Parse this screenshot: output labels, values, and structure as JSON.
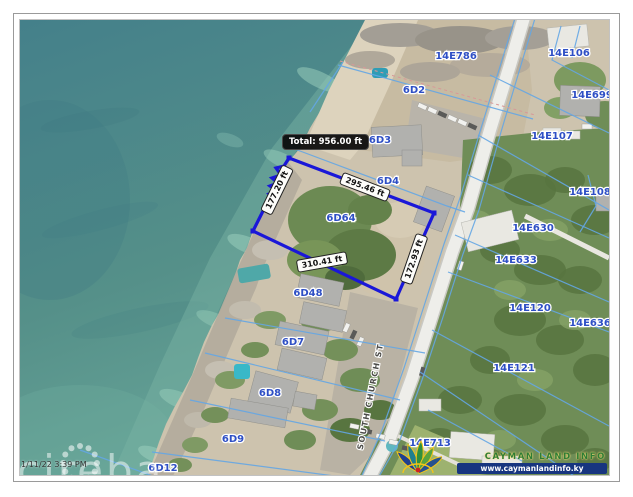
{
  "map": {
    "parcels": [
      {
        "id": "14E786"
      },
      {
        "id": "6D2"
      },
      {
        "id": "6D3"
      },
      {
        "id": "6D4"
      },
      {
        "id": "6D64"
      },
      {
        "id": "6D48"
      },
      {
        "id": "6D7"
      },
      {
        "id": "6D8"
      },
      {
        "id": "6D9"
      },
      {
        "id": "6D12"
      },
      {
        "id": "14E106"
      },
      {
        "id": "14E699"
      },
      {
        "id": "14E107"
      },
      {
        "id": "14E108"
      },
      {
        "id": "14E630"
      },
      {
        "id": "14E633"
      },
      {
        "id": "14E120"
      },
      {
        "id": "14E636"
      },
      {
        "id": "14E121"
      },
      {
        "id": "14E713"
      }
    ],
    "road_label": "SOUTH CHURCH ST",
    "selected_parcel": "6D64",
    "measurement": {
      "total": "Total: 956.00 ft",
      "segments": [
        {
          "side": "west",
          "label": "177.20 ft"
        },
        {
          "side": "north",
          "label": "295.46 ft"
        },
        {
          "side": "south",
          "label": "310.41 ft"
        },
        {
          "side": "east",
          "label": "172.93 ft"
        }
      ]
    }
  },
  "watermark": {
    "brand": "cireba",
    "timestamp": "1/11/22 3:39 PM"
  },
  "branding": {
    "title": "CAYMAN LAND INFO",
    "website": "www.caymanlandinfo.ky"
  },
  "colors": {
    "selection_outline": "#1a17d8",
    "cadastral_line": "#64a6e4",
    "parcel_label": "#2e4fc5",
    "ocean": "#4a868e",
    "tooltip_bg": "#0a0a0a"
  }
}
